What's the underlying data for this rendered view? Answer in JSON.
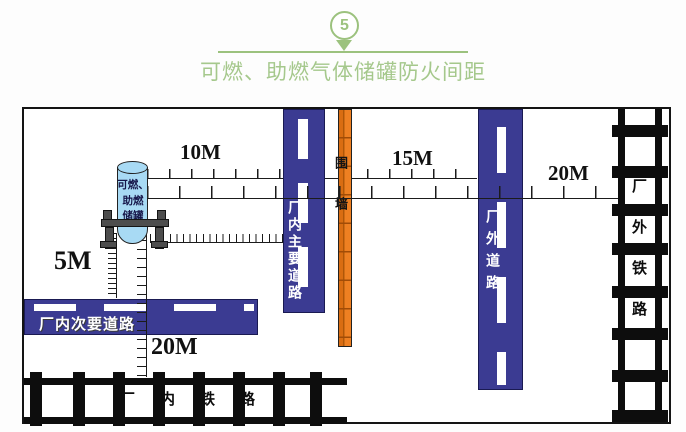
{
  "header": {
    "badge": "5",
    "title": "可燃、助燃气体储罐防火间距"
  },
  "tank": {
    "lines": [
      "可燃、",
      "助燃",
      "储罐"
    ]
  },
  "distances": {
    "to_main_road": "10M",
    "to_outer_road": "15M",
    "to_outer_railway": "20M",
    "to_secondary_road": "5M",
    "to_inner_railway": "20M"
  },
  "features": {
    "main_road": "厂内主要道路",
    "wall": "围墙",
    "outer_road": "厂外道路",
    "outer_railway": "厂外铁路",
    "secondary_road": "厂内次要道路",
    "inner_railway": "厂内铁路"
  },
  "colors": {
    "accent_green": "#9cc27e",
    "road_blue": "#3b3b92",
    "wall_orange": "#ee8022",
    "tank_blue": "#a8daf4"
  }
}
